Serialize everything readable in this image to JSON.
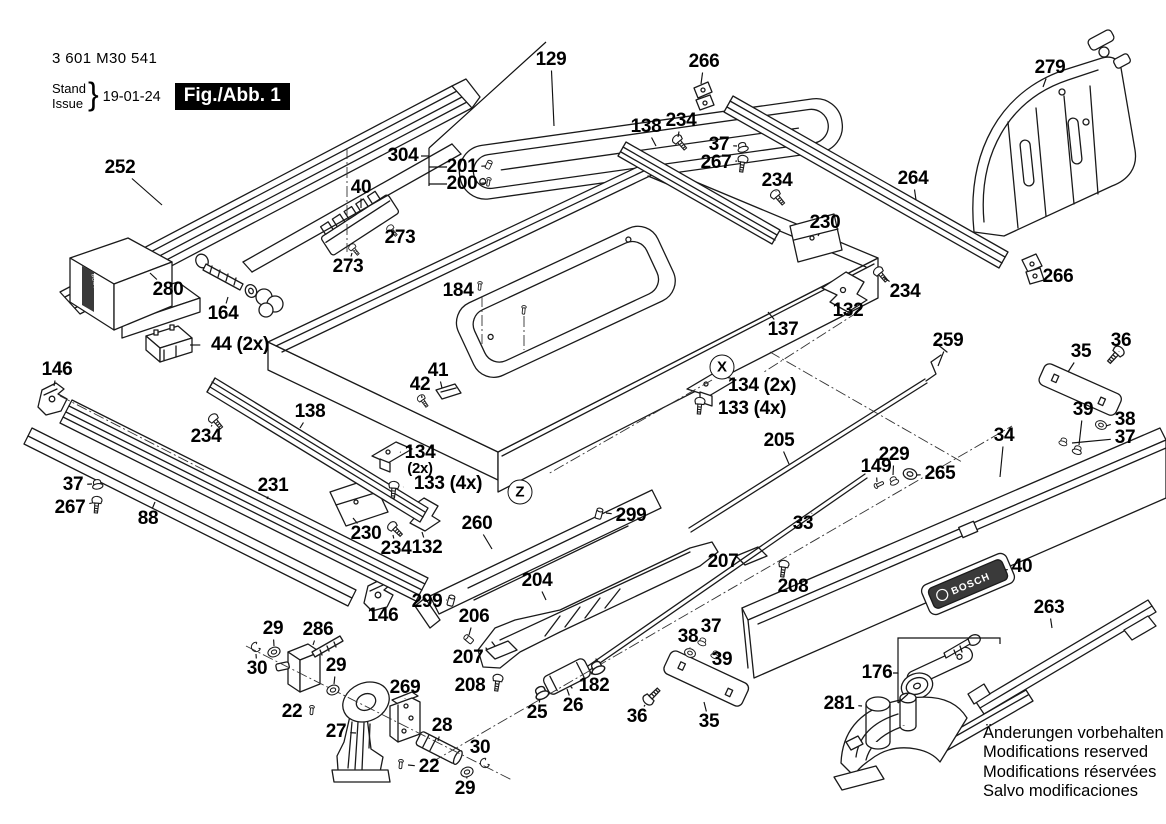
{
  "meta": {
    "part_number": "3 601 M30 541",
    "stand_label": "Stand",
    "issue_label": "Issue",
    "date": "19-01-24",
    "figure": "Fig./Abb. 1"
  },
  "brand": {
    "logo_text": "BOSCH"
  },
  "footer": {
    "lines": [
      "Änderungen vorbehalten",
      "Modifications reserved",
      "Modifications réservées",
      "Salvo modificaciones"
    ]
  },
  "colors": {
    "line": "#1a1a1a",
    "plate_dark": "#3a3a3a"
  },
  "callouts": [
    {
      "letter": "X",
      "x": 722,
      "y": 367
    },
    {
      "letter": "Z",
      "x": 520,
      "y": 492
    }
  ],
  "labels": [
    {
      "text": "252",
      "x": 120,
      "y": 168,
      "lx": 162,
      "ly": 205
    },
    {
      "text": "40",
      "x": 361,
      "y": 188,
      "lx": 361,
      "ly": 208
    },
    {
      "text": "273",
      "x": 400,
      "y": 238,
      "lx": 392,
      "ly": 231
    },
    {
      "text": "273",
      "x": 348,
      "y": 267,
      "lx": 352,
      "ly": 253
    },
    {
      "text": "304",
      "x": 403,
      "y": 156
    },
    {
      "text": "201",
      "x": 462,
      "y": 167,
      "lx": 486,
      "ly": 166
    },
    {
      "text": "200",
      "x": 462,
      "y": 184,
      "lx": 486,
      "ly": 183
    },
    {
      "text": "129",
      "x": 551,
      "y": 60,
      "lx": 554,
      "ly": 126
    },
    {
      "text": "266",
      "x": 704,
      "y": 62,
      "lx": 701,
      "ly": 84
    },
    {
      "text": "138",
      "x": 646,
      "y": 127,
      "lx": 656,
      "ly": 146
    },
    {
      "text": "234",
      "x": 681,
      "y": 121,
      "lx": 678,
      "ly": 137
    },
    {
      "text": "37",
      "x": 719,
      "y": 145,
      "lx": 737,
      "ly": 146
    },
    {
      "text": "267",
      "x": 716,
      "y": 163,
      "lx": 737,
      "ly": 161
    },
    {
      "text": "234",
      "x": 777,
      "y": 181,
      "lx": 776,
      "ly": 192
    },
    {
      "text": "264",
      "x": 913,
      "y": 179,
      "lx": 916,
      "ly": 200
    },
    {
      "text": "279",
      "x": 1050,
      "y": 68,
      "lx": 1043,
      "ly": 87
    },
    {
      "text": "230",
      "x": 825,
      "y": 223,
      "lx": 818,
      "ly": 236
    },
    {
      "text": "266",
      "x": 1058,
      "y": 277,
      "lx": 1042,
      "ly": 273
    },
    {
      "text": "234",
      "x": 905,
      "y": 292,
      "lx": 883,
      "ly": 277
    },
    {
      "text": "132",
      "x": 848,
      "y": 311,
      "lx": 845,
      "ly": 301
    },
    {
      "text": "137",
      "x": 783,
      "y": 330,
      "lx": 768,
      "ly": 312
    },
    {
      "text": "184",
      "x": 458,
      "y": 291,
      "lx": 476,
      "ly": 288
    },
    {
      "text": "280",
      "x": 168,
      "y": 290,
      "lx": 150,
      "ly": 273
    },
    {
      "text": "164",
      "x": 223,
      "y": 314,
      "lx": 228,
      "ly": 297
    },
    {
      "text": "44 (2x)",
      "x": 240,
      "y": 345,
      "lx": 190,
      "ly": 345
    },
    {
      "text": "146",
      "x": 57,
      "y": 370,
      "lx": 54,
      "ly": 386
    },
    {
      "text": "138",
      "x": 310,
      "y": 412,
      "lx": 300,
      "ly": 428
    },
    {
      "text": "234",
      "x": 206,
      "y": 437,
      "lx": 212,
      "ly": 425
    },
    {
      "text": "42",
      "x": 420,
      "y": 385,
      "lx": 422,
      "ly": 398
    },
    {
      "text": "41",
      "x": 438,
      "y": 371,
      "lx": 442,
      "ly": 388
    },
    {
      "text": "134 (2x)",
      "x": 762,
      "y": 386,
      "lx": 720,
      "ly": 384
    },
    {
      "text": "133 (4x)",
      "x": 752,
      "y": 409,
      "lx": 710,
      "ly": 406
    },
    {
      "text": "259",
      "x": 948,
      "y": 341,
      "lx": 938,
      "ly": 366
    },
    {
      "text": "36",
      "x": 1121,
      "y": 341,
      "lx": 1119,
      "ly": 352
    },
    {
      "text": "35",
      "x": 1081,
      "y": 352,
      "lx": 1068,
      "ly": 372
    },
    {
      "text": "39",
      "x": 1083,
      "y": 410,
      "lx": 1079,
      "ly": 445
    },
    {
      "text": "38",
      "x": 1125,
      "y": 420,
      "lx": 1106,
      "ly": 426
    },
    {
      "text": "37",
      "x": 1125,
      "y": 438,
      "lx": 1072,
      "ly": 443
    },
    {
      "text": "34",
      "x": 1004,
      "y": 436,
      "lx": 1000,
      "ly": 477
    },
    {
      "text": "37",
      "x": 73,
      "y": 485,
      "lx": 92,
      "ly": 484
    },
    {
      "text": "267",
      "x": 70,
      "y": 508,
      "lx": 92,
      "ly": 503
    },
    {
      "text": "88",
      "x": 148,
      "y": 519,
      "lx": 155,
      "ly": 502
    },
    {
      "text": "231",
      "x": 273,
      "y": 486,
      "lx": 267,
      "ly": 499
    },
    {
      "text": "134",
      "text2": "(2x)",
      "x": 420,
      "y": 460,
      "lx": 400,
      "ly": 452
    },
    {
      "text": "133 (4x)",
      "x": 448,
      "y": 484,
      "lx": 403,
      "ly": 487
    },
    {
      "text": "230",
      "x": 366,
      "y": 534,
      "lx": 353,
      "ly": 518
    },
    {
      "text": "234",
      "x": 396,
      "y": 549,
      "lx": 393,
      "ly": 535
    },
    {
      "text": "132",
      "x": 427,
      "y": 548,
      "lx": 422,
      "ly": 532
    },
    {
      "text": "260",
      "x": 477,
      "y": 524,
      "lx": 492,
      "ly": 549
    },
    {
      "text": "299",
      "x": 631,
      "y": 516,
      "lx": 606,
      "ly": 513
    },
    {
      "text": "205",
      "x": 779,
      "y": 441,
      "lx": 789,
      "ly": 464
    },
    {
      "text": "229",
      "x": 894,
      "y": 455,
      "lx": 893,
      "ly": 475
    },
    {
      "text": "149",
      "x": 876,
      "y": 467,
      "lx": 877,
      "ly": 482
    },
    {
      "text": "265",
      "x": 940,
      "y": 474,
      "lx": 917,
      "ly": 475
    },
    {
      "text": "33",
      "x": 803,
      "y": 524,
      "lx": 812,
      "ly": 513
    },
    {
      "text": "299",
      "x": 427,
      "y": 602,
      "lx": 447,
      "ly": 600
    },
    {
      "text": "146",
      "x": 383,
      "y": 616,
      "lx": 379,
      "ly": 607
    },
    {
      "text": "204",
      "x": 537,
      "y": 581,
      "lx": 546,
      "ly": 600
    },
    {
      "text": "206",
      "x": 474,
      "y": 617,
      "lx": 469,
      "ly": 635
    },
    {
      "text": "207",
      "x": 468,
      "y": 658,
      "lx": 485,
      "ly": 655
    },
    {
      "text": "208",
      "x": 470,
      "y": 686,
      "lx": 488,
      "ly": 684
    },
    {
      "text": "207",
      "x": 723,
      "y": 562,
      "lx": 740,
      "ly": 559
    },
    {
      "text": "208",
      "x": 793,
      "y": 587,
      "lx": 784,
      "ly": 576
    },
    {
      "text": "25",
      "x": 537,
      "y": 713,
      "lx": 540,
      "ly": 699
    },
    {
      "text": "26",
      "x": 573,
      "y": 706,
      "lx": 567,
      "ly": 689
    },
    {
      "text": "182",
      "x": 594,
      "y": 686,
      "lx": 596,
      "ly": 676
    },
    {
      "text": "36",
      "x": 637,
      "y": 717,
      "lx": 645,
      "ly": 705
    },
    {
      "text": "35",
      "x": 709,
      "y": 722,
      "lx": 704,
      "ly": 702
    },
    {
      "text": "38",
      "x": 688,
      "y": 637,
      "lx": 690,
      "ly": 648
    },
    {
      "text": "37",
      "x": 711,
      "y": 627,
      "lx": 704,
      "ly": 637
    },
    {
      "text": "39",
      "x": 722,
      "y": 660,
      "lx": 715,
      "ly": 656
    },
    {
      "text": "29",
      "x": 273,
      "y": 629,
      "lx": 274,
      "ly": 646
    },
    {
      "text": "30",
      "x": 257,
      "y": 669,
      "lx": 256,
      "ly": 654
    },
    {
      "text": "286",
      "x": 318,
      "y": 630,
      "lx": 313,
      "ly": 645
    },
    {
      "text": "29",
      "x": 336,
      "y": 666,
      "lx": 334,
      "ly": 684
    },
    {
      "text": "22",
      "x": 292,
      "y": 712,
      "lx": 306,
      "ly": 710
    },
    {
      "text": "27",
      "x": 336,
      "y": 732,
      "lx": 356,
      "ly": 733
    },
    {
      "text": "269",
      "x": 405,
      "y": 688,
      "lx": 405,
      "ly": 699
    },
    {
      "text": "28",
      "x": 442,
      "y": 726,
      "lx": 438,
      "ly": 741
    },
    {
      "text": "22",
      "x": 429,
      "y": 767,
      "lx": 408,
      "ly": 765
    },
    {
      "text": "30",
      "x": 480,
      "y": 748,
      "lx": 484,
      "ly": 759
    },
    {
      "text": "29",
      "x": 465,
      "y": 789,
      "lx": 467,
      "ly": 777
    },
    {
      "text": "40",
      "x": 1022,
      "y": 567,
      "lx": 1005,
      "ly": 570
    },
    {
      "text": "263",
      "x": 1049,
      "y": 608,
      "lx": 1052,
      "ly": 628
    },
    {
      "text": "176",
      "x": 877,
      "y": 673
    },
    {
      "text": "281",
      "x": 839,
      "y": 704,
      "lx": 862,
      "ly": 706
    }
  ],
  "hardware": [
    {
      "part": "273",
      "type": "screw",
      "x": 352,
      "y": 247,
      "rot": -40,
      "s": 0.75
    },
    {
      "part": "273",
      "type": "screw",
      "x": 390,
      "y": 228,
      "rot": -40,
      "s": 0.75
    },
    {
      "part": "201",
      "type": "grub",
      "x": 490,
      "y": 162,
      "rot": 25,
      "s": 0.8
    },
    {
      "part": "200",
      "type": "pin",
      "x": 489,
      "y": 179,
      "rot": 10,
      "s": 0.8
    },
    {
      "part": "234",
      "type": "screw",
      "x": 677,
      "y": 139,
      "rot": -40
    },
    {
      "part": "37",
      "type": "nut",
      "x": 742,
      "y": 145,
      "rot": -15
    },
    {
      "part": "267",
      "type": "screw",
      "x": 743,
      "y": 159,
      "rot": 8
    },
    {
      "part": "234",
      "type": "screw",
      "x": 775,
      "y": 194,
      "rot": -40
    },
    {
      "part": "234",
      "type": "screw",
      "x": 878,
      "y": 271,
      "rot": -40
    },
    {
      "part": "234",
      "type": "screw",
      "x": 213,
      "y": 418,
      "rot": -40
    },
    {
      "part": "234",
      "type": "screw",
      "x": 392,
      "y": 526,
      "rot": -45
    },
    {
      "part": "184",
      "type": "pin",
      "x": 480,
      "y": 283,
      "rot": 5,
      "s": 0.8
    },
    {
      "part": "184",
      "type": "pin",
      "x": 524,
      "y": 307,
      "rot": 5,
      "s": 0.8
    },
    {
      "part": "42",
      "type": "screw",
      "x": 421,
      "y": 398,
      "rot": -35,
      "s": 0.8
    },
    {
      "part": "133",
      "type": "screw",
      "x": 700,
      "y": 401,
      "rot": 5
    },
    {
      "part": "133",
      "type": "screw",
      "x": 394,
      "y": 485,
      "rot": 5
    },
    {
      "part": "299",
      "type": "grub",
      "x": 600,
      "y": 510,
      "rot": 15
    },
    {
      "part": "299",
      "type": "grub",
      "x": 452,
      "y": 597,
      "rot": 15
    },
    {
      "part": "206",
      "type": "grub",
      "x": 466,
      "y": 637,
      "rot": -50,
      "s": 0.9
    },
    {
      "part": "208",
      "type": "screw",
      "x": 498,
      "y": 678,
      "rot": 8
    },
    {
      "part": "208",
      "type": "screw",
      "x": 784,
      "y": 564,
      "rot": 8
    },
    {
      "part": "267",
      "type": "screw",
      "x": 97,
      "y": 500,
      "rot": 5
    },
    {
      "part": "37",
      "type": "nut",
      "x": 97,
      "y": 482,
      "rot": -10
    },
    {
      "part": "36",
      "type": "screw",
      "x": 1119,
      "y": 351,
      "rot": 42,
      "s": 1.15
    },
    {
      "part": "39",
      "type": "nut",
      "x": 1078,
      "y": 448,
      "rot": 18,
      "s": 0.9
    },
    {
      "part": "38",
      "type": "washer",
      "x": 1101,
      "y": 425,
      "rot": 18,
      "s": 0.9
    },
    {
      "part": "37",
      "type": "nut",
      "x": 1064,
      "y": 440,
      "rot": 18,
      "s": 0.8
    },
    {
      "part": "36",
      "type": "screw",
      "x": 648,
      "y": 700,
      "rot": -135,
      "s": 1.15
    },
    {
      "part": "38",
      "type": "washer",
      "x": 690,
      "y": 653,
      "rot": 20,
      "s": 0.9
    },
    {
      "part": "37",
      "type": "nut",
      "x": 703,
      "y": 640,
      "rot": 20,
      "s": 0.8
    },
    {
      "part": "39",
      "type": "nut",
      "x": 716,
      "y": 653,
      "rot": 20,
      "s": 0.8
    },
    {
      "part": "25",
      "type": "nut",
      "x": 540,
      "y": 690,
      "rot": -25,
      "s": 1.3
    },
    {
      "part": "182",
      "type": "nut",
      "x": 596,
      "y": 665,
      "rot": -25,
      "s": 1.3
    },
    {
      "part": "265",
      "type": "washer",
      "x": 910,
      "y": 474,
      "rot": 15,
      "s": 1.1
    },
    {
      "part": "229",
      "type": "nut",
      "x": 893,
      "y": 479,
      "rot": -25,
      "s": 0.85
    },
    {
      "part": "149",
      "type": "pin",
      "x": 876,
      "y": 486,
      "rot": -115,
      "s": 0.9
    },
    {
      "part": "29",
      "type": "washer",
      "x": 274,
      "y": 652,
      "rot": -20
    },
    {
      "part": "30",
      "type": "cclip",
      "x": 256,
      "y": 647,
      "rot": -30,
      "s": 0.9
    },
    {
      "part": "29",
      "type": "washer",
      "x": 333,
      "y": 690,
      "rot": -20
    },
    {
      "part": "22",
      "type": "pin",
      "x": 312,
      "y": 707,
      "rot": 5,
      "s": 0.85
    },
    {
      "part": "22",
      "type": "pin",
      "x": 401,
      "y": 761,
      "rot": 5,
      "s": 0.85
    },
    {
      "part": "29",
      "type": "washer",
      "x": 467,
      "y": 772,
      "rot": -20
    },
    {
      "part": "30",
      "type": "cclip",
      "x": 485,
      "y": 763,
      "rot": -30,
      "s": 0.9
    }
  ]
}
